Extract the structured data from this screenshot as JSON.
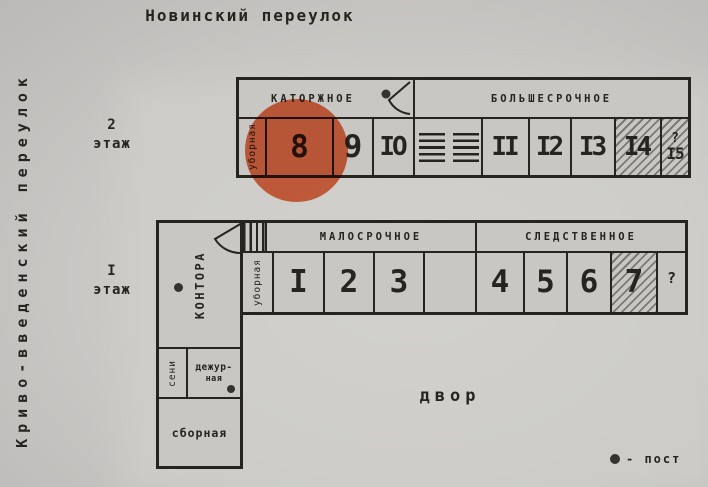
{
  "streets": {
    "top": "Новинский переулок",
    "left": "Криво-введенский переулок"
  },
  "floor2": {
    "label": {
      "num": "2",
      "word": "этаж"
    },
    "sections": {
      "left": "КАТОРЖНОЕ",
      "right": "БОЛЬШЕСРОЧНОЕ"
    },
    "toilet": "уборная",
    "cells": {
      "c8": "8",
      "c9": "9",
      "c10": "IO",
      "c11": "II",
      "c12": "I2",
      "c13": "I3",
      "c14": "I4",
      "c15_q": "?",
      "c15": "I5"
    }
  },
  "floor1": {
    "label": {
      "num": "I",
      "word": "этаж"
    },
    "sections": {
      "left": "МАЛОСРОЧНОЕ",
      "right": "СЛЕДСТВЕННОЕ"
    },
    "toilet": "уборная",
    "office": "КОНТОРА",
    "entry": "сени",
    "duty": {
      "line1": "дежур-",
      "line2": "ная"
    },
    "assembly": "сборная",
    "cells": {
      "c1": "I",
      "c2": "2",
      "c3": "3",
      "c4": "4",
      "c5": "5",
      "c6": "6",
      "c7": "7",
      "q": "?"
    }
  },
  "courtyard": "двор",
  "legend": {
    "text": "- пост"
  },
  "highlight": {
    "room": "8",
    "color": "#e8663d"
  }
}
